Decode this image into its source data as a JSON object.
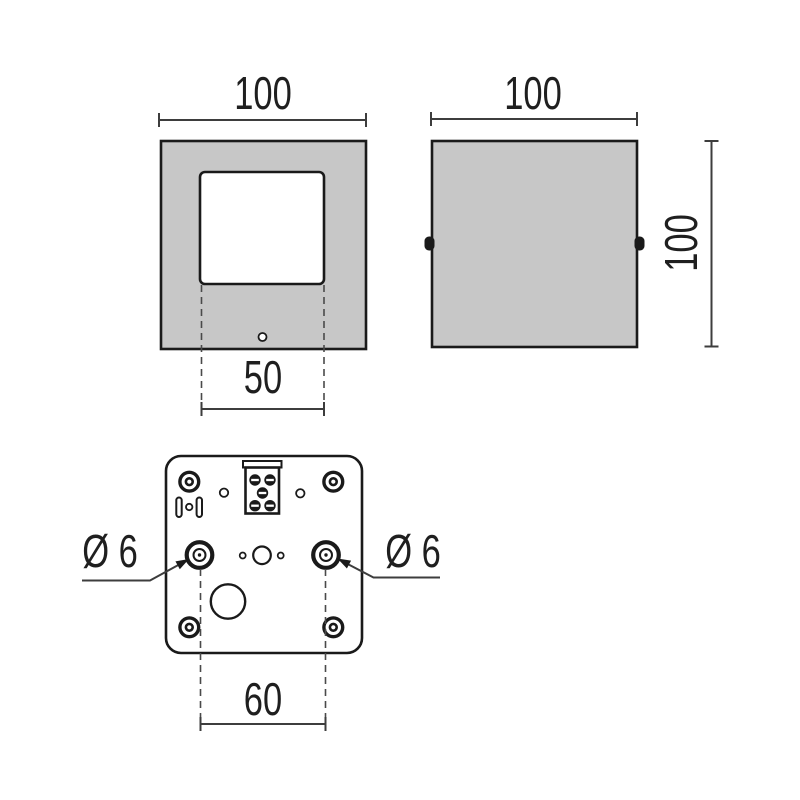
{
  "drawing": {
    "title": "luminaire-dimension-drawing",
    "colors": {
      "background": "#ffffff",
      "body_fill": "#c7c7c7",
      "outline": "#1a1a1a",
      "dimension_line": "#3d3d3d"
    },
    "views": {
      "front": {
        "name": "front-view",
        "labels": {
          "overall_width": "100",
          "window_width": "50"
        }
      },
      "side": {
        "name": "side-view",
        "labels": {
          "overall_width": "100",
          "overall_height": "100"
        }
      },
      "base": {
        "name": "base-view",
        "labels": {
          "hole_left_diameter": "Ø 6",
          "hole_right_diameter": "Ø 6",
          "hole_spacing": "60"
        }
      }
    }
  }
}
